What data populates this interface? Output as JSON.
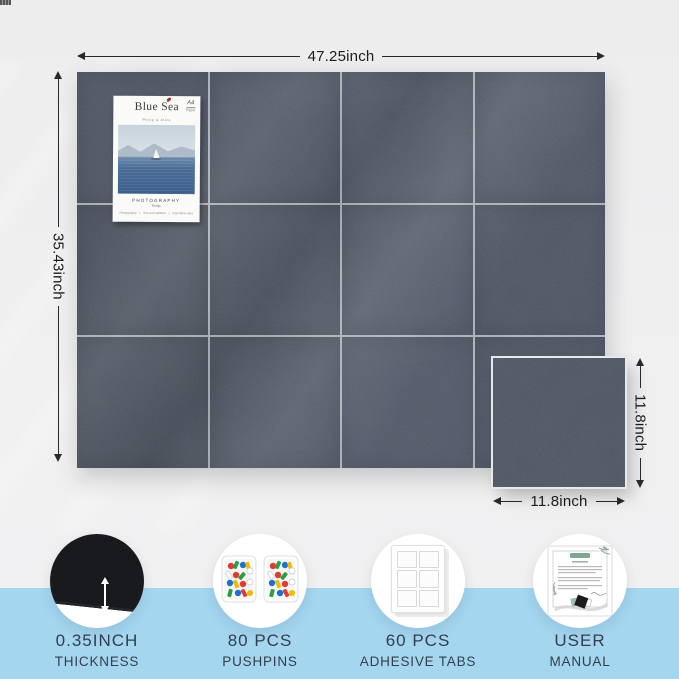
{
  "colors": {
    "canvas_bg": "#efeff0",
    "bottom_band": "#a4d6f0",
    "felt": "#4f5663",
    "label_text": "#333e4a",
    "dimension_line": "#26292d",
    "pin_red": "#e23b2e",
    "pin_green": "#2d9e44",
    "pin_blue": "#1f6fd0",
    "pin_yellow": "#f2b900",
    "manual_green": "#7fa890"
  },
  "board": {
    "rows": 3,
    "cols": 4
  },
  "dimensions": {
    "board_width": "47.25inch",
    "board_height": "35.43inch",
    "tile_height": "11.8inch",
    "tile_width": "11.8inch"
  },
  "poster": {
    "title": "Blue Sea",
    "subtitle": "Philip & Alice",
    "corner_mark": "A4",
    "corner_mark_sub": "Paper",
    "caption": "PHOTOGRAPHY",
    "caption_sub": "Philip",
    "footer_separator": "|",
    "footer_items": [
      "Photography",
      "Sea and sailboat",
      "Inspiration idea"
    ]
  },
  "features": [
    {
      "line1": "0.35INCH",
      "line2": "THICKNESS"
    },
    {
      "line1": "80 PCS",
      "line2": "PUSHPINS"
    },
    {
      "line1": "60 PCS",
      "line2": "ADHESIVE TABS"
    },
    {
      "line1": "USER",
      "line2": "MANUAL"
    }
  ]
}
